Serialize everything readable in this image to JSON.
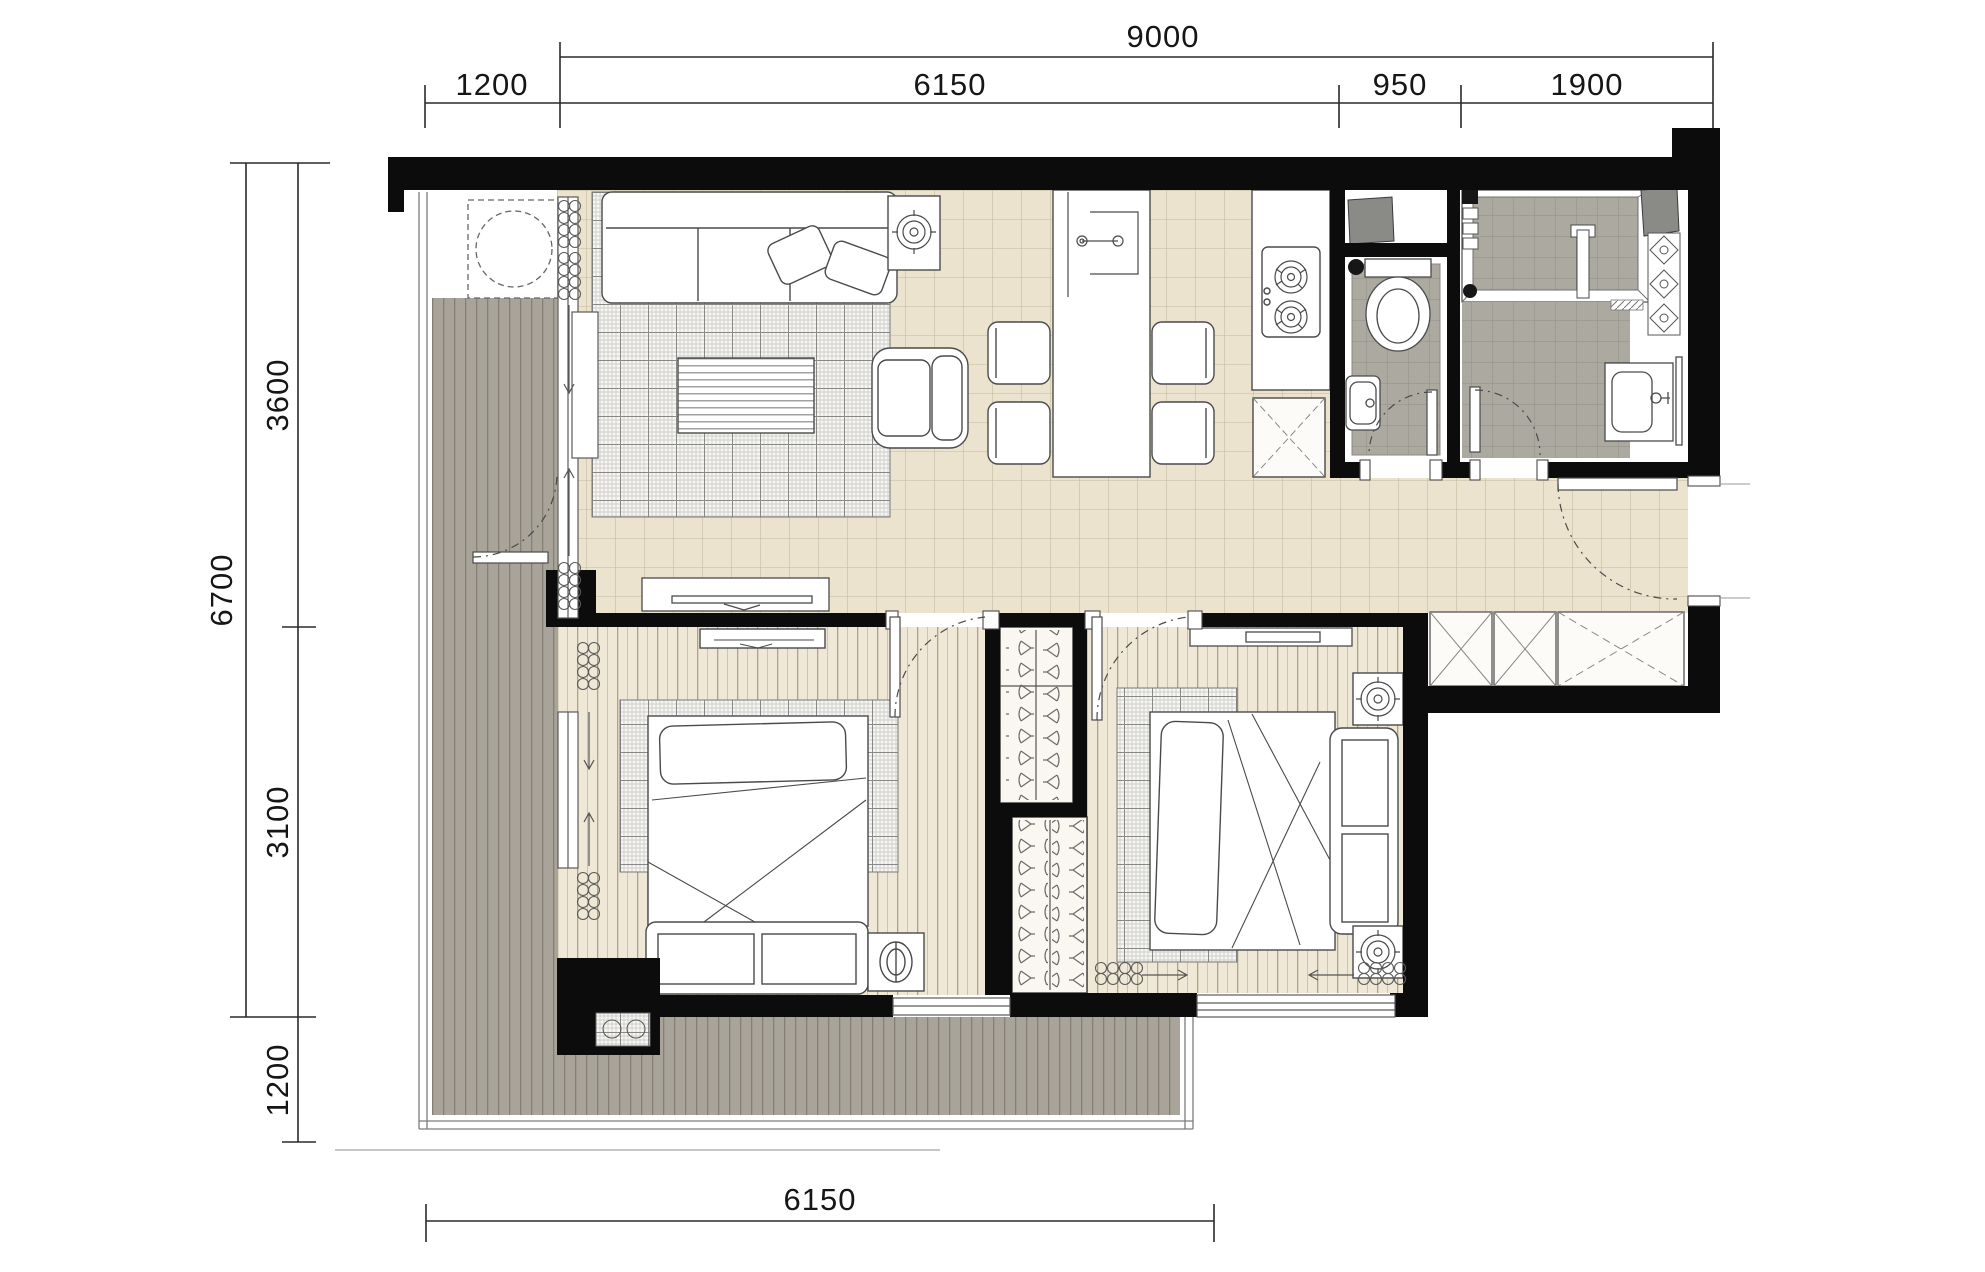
{
  "drawing": {
    "type": "apartment-floor-plan",
    "dimensions": {
      "top_total": "9000",
      "top_segments": [
        "1200",
        "6150",
        "950",
        "1900"
      ],
      "left_total": "6700",
      "left_segments": [
        "3600",
        "3100"
      ],
      "left_lower": "1200",
      "bottom_total": "6150"
    },
    "colors": {
      "wall": "#0c0c0c",
      "tile_floor": "#EBE3CD",
      "tile_line": "#C3B89D",
      "wood_floor": "#EFE8D6",
      "wood_line": "#B6AB92",
      "deck": "#A9A499",
      "deck_line": "#858071",
      "bath_tile": "#ABA9A0",
      "bath_tile_line": "#918F86",
      "fixture_gray": "#8A8A86",
      "outline": "#4a4a4a",
      "dimension": "#2a2a2a"
    }
  }
}
